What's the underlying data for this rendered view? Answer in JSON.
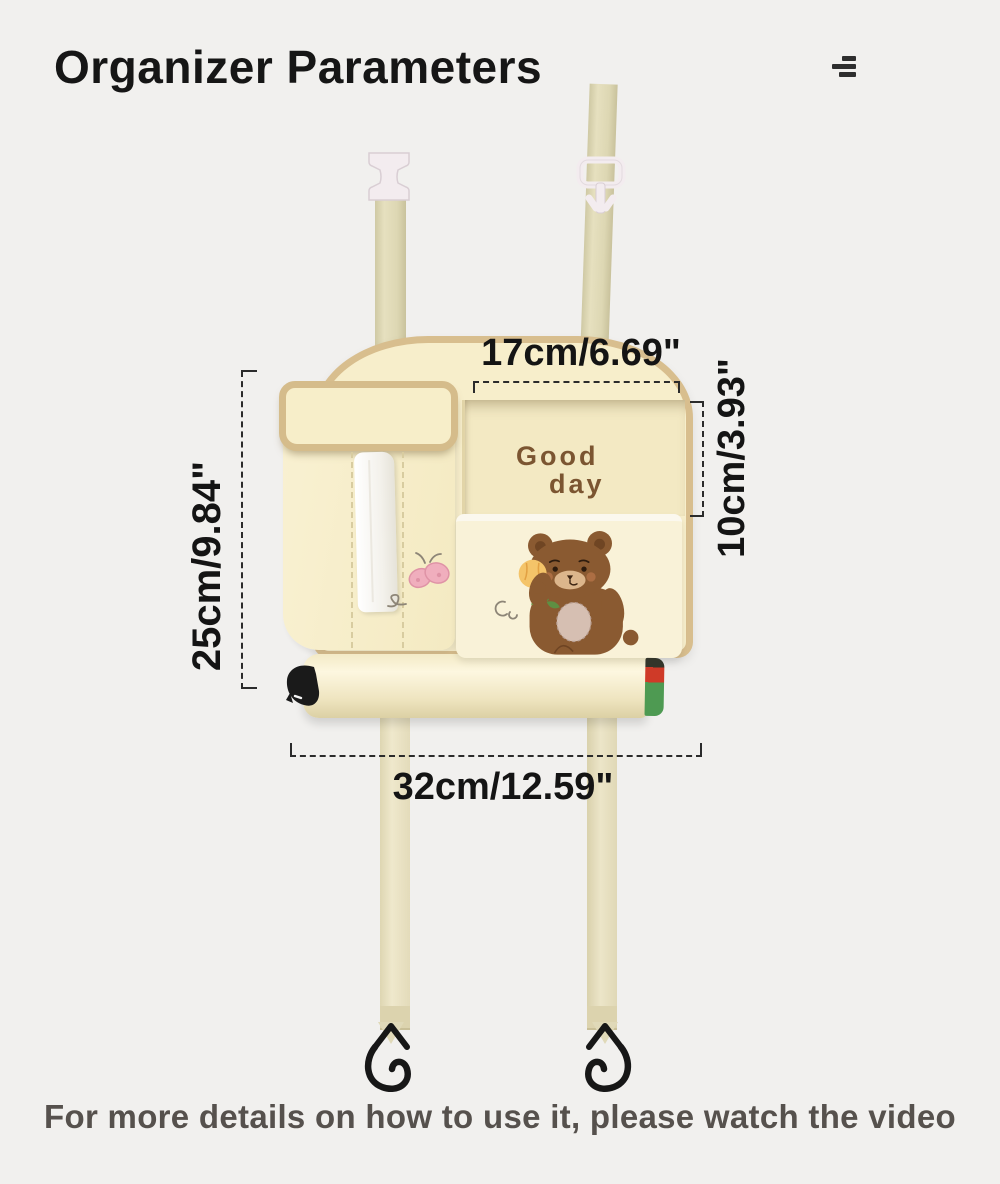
{
  "header": {
    "title": "Organizer Parameters",
    "menu_icon": "hamburger-menu-icon"
  },
  "annotations": {
    "top_pocket_width": "17cm/6.69\"",
    "pocket_depth": "10cm/3.93\"",
    "organizer_height": "25cm/9.84\"",
    "organizer_width": "32cm/12.59\""
  },
  "product": {
    "pocket_print_line1": "Good",
    "pocket_print_line2": "day",
    "illustrations": [
      "bear-with-tulip",
      "pink-butterfly",
      "tissue",
      "s-hooks",
      "strap-buckles"
    ]
  },
  "footer": {
    "caption": "For more details on how to use it, please watch the video"
  },
  "colors": {
    "background": "#f1f0ee",
    "body_cream": "#f7eecb",
    "trim_tan": "#d8be8e",
    "strap_khaki": "#ddd7b3",
    "pocket_interior": "#f3e9c3",
    "print_brown": "#7b5531",
    "bear_brown": "#8a5a31",
    "butterfly_pink": "#f0aebd",
    "annotation_text": "#141414",
    "caption_text": "#56514d",
    "roll_stripe_red": "#cf3a28",
    "roll_stripe_green": "#4e9a52"
  }
}
